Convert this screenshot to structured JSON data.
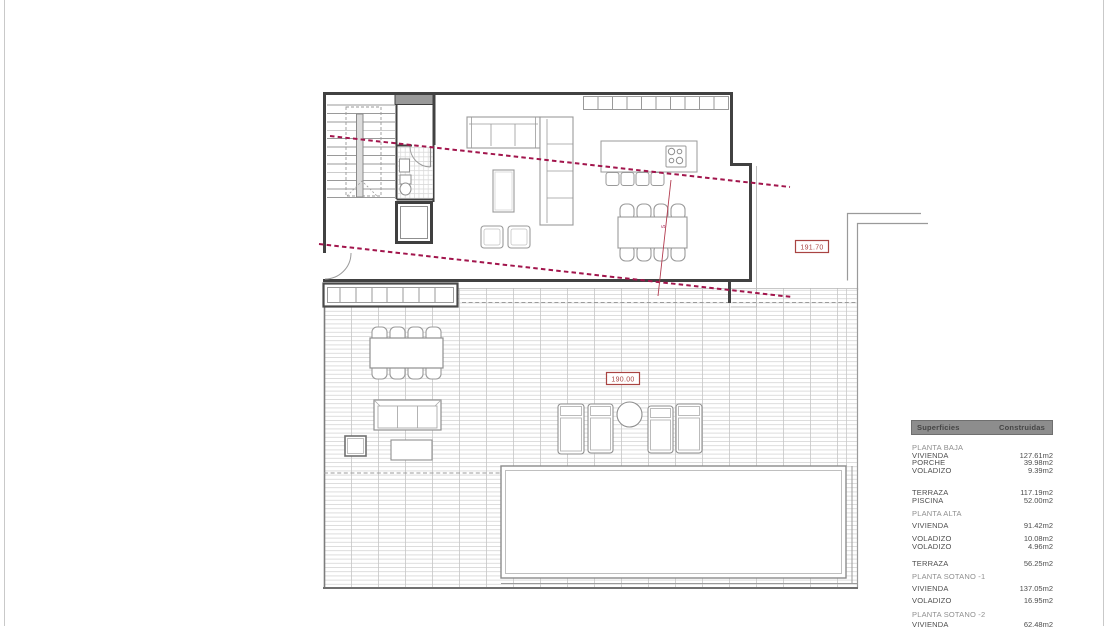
{
  "plan_labels": {
    "upper_level": "191.70",
    "lower_level": "190.00",
    "section_mark": "5"
  },
  "colors": {
    "wall": "#414141",
    "furniture_line": "#9a9a9a",
    "hatch_line": "#d6d6d6",
    "red_dashed_line": "#a2154c",
    "red_level_label": "#a94442",
    "legend_header_bg": "#8d8d8d",
    "legend_section_text": "#8f8f8f",
    "legend_item_text": "#4d4d4d"
  },
  "legend": {
    "header": {
      "left": "Superficies",
      "right": "Construidas"
    },
    "rows": [
      {
        "type": "section",
        "label": "PLANTA BAJA",
        "value": ""
      },
      {
        "type": "item",
        "label": "VIVIENDA",
        "value": "127.61m2"
      },
      {
        "type": "item",
        "label": "PORCHE",
        "value": "39.98m2"
      },
      {
        "type": "item",
        "label": "VOLADIZO",
        "value": "9.39m2"
      },
      {
        "type": "item",
        "label": "TERRAZA",
        "value": "117.19m2"
      },
      {
        "type": "item",
        "label": "PISCINA",
        "value": "52.00m2"
      },
      {
        "type": "section",
        "label": "PLANTA ALTA",
        "value": ""
      },
      {
        "type": "item",
        "label": "VIVIENDA",
        "value": "91.42m2"
      },
      {
        "type": "item",
        "label": "VOLADIZO",
        "value": "10.08m2"
      },
      {
        "type": "item",
        "label": "VOLADIZO",
        "value": "4.96m2"
      },
      {
        "type": "item",
        "label": "TERRAZA",
        "value": "56.25m2"
      },
      {
        "type": "section",
        "label": "PLANTA SOTANO -1",
        "value": ""
      },
      {
        "type": "item",
        "label": "VIVIENDA",
        "value": "137.05m2"
      },
      {
        "type": "item",
        "label": "VOLADIZO",
        "value": "16.95m2"
      },
      {
        "type": "section",
        "label": "PLANTA SOTANO -2",
        "value": ""
      },
      {
        "type": "item",
        "label": "VIVIENDA",
        "value": "62.48m2"
      }
    ]
  }
}
